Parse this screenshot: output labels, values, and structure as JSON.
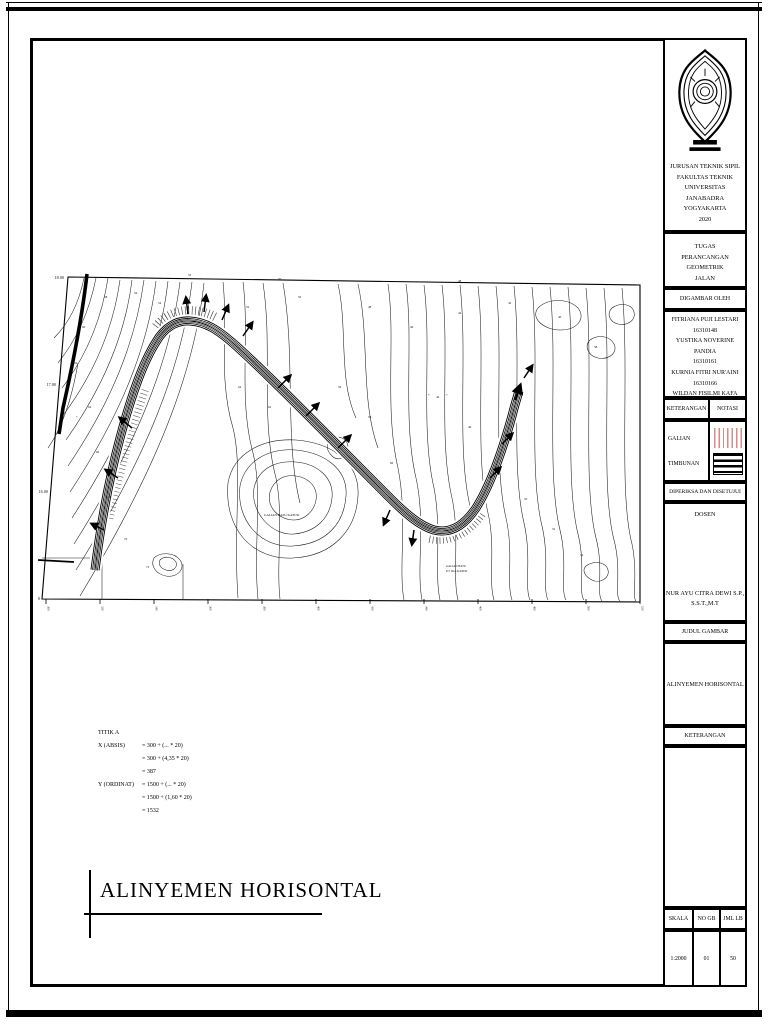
{
  "page": {
    "background": "#ffffff",
    "line_color": "#000000"
  },
  "title_block": {
    "institution": [
      "JURUSAN TEKNIK SIPIL",
      "FAKULTAS TEKNIK",
      "UNIVERSITAS JANABADRA",
      "YOGYAKARTA",
      "2020"
    ],
    "tugas_lines": [
      "TUGAS",
      "PERANCANGAN GEOMETRIK",
      "JALAN"
    ],
    "digambar_oleh": "DIGAMBAR OLEH",
    "authors": [
      {
        "name": "FITRIANA PUJI LESTARI",
        "nim": "16310148"
      },
      {
        "name": "YUSTIKA NOVERINE PANDIA",
        "nim": "16310161"
      },
      {
        "name": "KURNIA FITRI NUR'AINI",
        "nim": "16310166"
      },
      {
        "name": "WILDAN FISILMI KAFA",
        "nim": "16310214"
      }
    ],
    "keterangan": "KETERANGAN",
    "notasi": "NOTASI",
    "galian": "GALIAN",
    "timbunan": "TIMBUNAN",
    "galian_color": "#d98a8a",
    "diperiksa": "DIPERIKSA DAN DISETUJUI",
    "dosen": "DOSEN",
    "dosen_name": [
      "NUR AYU CITRA DEWI S.P.,",
      "S.S.T.,M.T"
    ],
    "judul_gambar": "JUDUL GAMBAR",
    "judul_value": "ALINYEMEN HORISONTAL",
    "keterangan_bawah": "KETERANGAN",
    "skala_label": "SKALA",
    "skala_value": "1:2000",
    "no_gb_label": "NO GB",
    "no_gb_value": "01",
    "jml_lb_label": "JML LB",
    "jml_lb_value": "50"
  },
  "drawing": {
    "main_title": "ALINYEMEN HORISONTAL",
    "calc": {
      "title": "TITIK A",
      "x_label": "X (ABSIS)",
      "x_lines": [
        "= 300 + (... * 20)",
        "= 300 + (4,35 * 20)",
        "= 387"
      ],
      "y_label": "Y (ORDINAT)",
      "y_lines": [
        "= 1500 + (... * 20)",
        "= 1500 + (1,60 * 20)",
        "= 1532"
      ]
    },
    "map": {
      "y_axis_labels": [
        "18.00",
        "17.00",
        "16.00",
        "15.00"
      ],
      "x_axis_labels": [
        "300",
        "320",
        "340",
        "360",
        "380",
        "400",
        "420",
        "440",
        "460",
        "480",
        "500",
        "520"
      ],
      "labels": [
        {
          "t": "58",
          "x": 66,
          "y": 30
        },
        {
          "t": "56",
          "x": 96,
          "y": 26
        },
        {
          "t": "54",
          "x": 120,
          "y": 36
        },
        {
          "t": "60",
          "x": 44,
          "y": 60
        },
        {
          "t": "62",
          "x": 36,
          "y": 96
        },
        {
          "t": "64",
          "x": 50,
          "y": 140
        },
        {
          "t": "66",
          "x": 58,
          "y": 185
        },
        {
          "t": "68",
          "x": 70,
          "y": 230
        },
        {
          "t": "70",
          "x": 86,
          "y": 272
        },
        {
          "t": "72",
          "x": 108,
          "y": 300
        },
        {
          "t": "52",
          "x": 208,
          "y": 40
        },
        {
          "t": "50",
          "x": 260,
          "y": 30
        },
        {
          "t": "48",
          "x": 330,
          "y": 40
        },
        {
          "t": "46",
          "x": 372,
          "y": 60
        },
        {
          "t": "44",
          "x": 420,
          "y": 46
        },
        {
          "t": "42",
          "x": 470,
          "y": 36
        },
        {
          "t": "40",
          "x": 520,
          "y": 50
        },
        {
          "t": "38",
          "x": 556,
          "y": 80
        },
        {
          "t": "44",
          "x": 398,
          "y": 130
        },
        {
          "t": "46",
          "x": 430,
          "y": 160
        },
        {
          "t": "48",
          "x": 458,
          "y": 200
        },
        {
          "t": "50",
          "x": 486,
          "y": 232
        },
        {
          "t": "52",
          "x": 514,
          "y": 262
        },
        {
          "t": "54",
          "x": 542,
          "y": 288
        },
        {
          "t": "56",
          "x": 300,
          "y": 120
        },
        {
          "t": "58",
          "x": 330,
          "y": 150
        },
        {
          "t": "60",
          "x": 352,
          "y": 196
        },
        {
          "t": "62",
          "x": 230,
          "y": 140
        },
        {
          "t": "64",
          "x": 200,
          "y": 120
        },
        {
          "t": "52",
          "x": 150,
          "y": 8
        },
        {
          "t": "50",
          "x": 240,
          "y": 12
        },
        {
          "t": "48",
          "x": 420,
          "y": 14
        },
        {
          "t": "+",
          "x": 390,
          "y": 128
        },
        {
          "t": "+",
          "x": 408,
          "y": 128
        },
        {
          "t": "+",
          "x": 38,
          "y": 150
        },
        {
          "t": "GALIAN BATU KAPUR",
          "x": 226,
          "y": 248,
          "s": 3.4
        },
        {
          "t": "GALIAN BATU",
          "x": 408,
          "y": 299,
          "s": 3
        },
        {
          "t": "P.T. IKA KAPUR",
          "x": 408,
          "y": 304,
          "s": 3
        }
      ]
    }
  }
}
